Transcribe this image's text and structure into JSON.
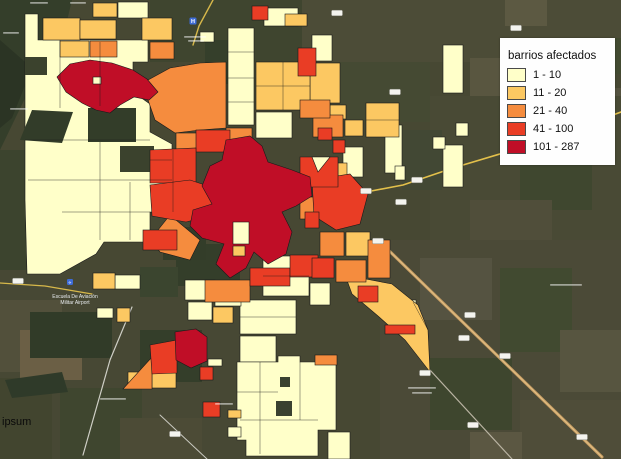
{
  "legend": {
    "title": "barrios afectados",
    "items": [
      {
        "label": "1 - 10",
        "color": "#FFFFC9"
      },
      {
        "label": "11 - 20",
        "color": "#FCC862"
      },
      {
        "label": "21 - 40",
        "color": "#F58C3E"
      },
      {
        "label": "41 - 100",
        "color": "#E93D25"
      },
      {
        "label": "101 - 287",
        "color": "#C00E27"
      }
    ]
  },
  "watermark": "ipsum",
  "markers": {
    "hospital": {
      "x": 193,
      "y": 21,
      "color": "#3d6bd6",
      "glyph": "H"
    },
    "airport": {
      "x": 70,
      "y": 282,
      "color": "#3d6bd6",
      "glyph": "✈",
      "label_line1": "Escuela De Aviación",
      "label_line2": "Militar Airport"
    }
  },
  "map": {
    "background": "#474833",
    "stroke": "#1a1a1a",
    "sat_patches": [
      {
        "x": 0,
        "y": 0,
        "w": 621,
        "h": 459,
        "f": "#474833"
      },
      {
        "pts": "0,0 72,0 58,58 28,92 0,150",
        "f": "#343e2a"
      },
      {
        "pts": "0,40 32,68 12,118 0,128",
        "f": "#2b3424"
      },
      {
        "x": 300,
        "y": 0,
        "w": 321,
        "h": 62,
        "f": "#4c4c37"
      },
      {
        "x": 505,
        "y": 0,
        "w": 42,
        "h": 26,
        "f": "#5c5942"
      },
      {
        "x": 560,
        "y": 38,
        "w": 61,
        "h": 36,
        "f": "#424a31"
      },
      {
        "x": 470,
        "y": 58,
        "w": 36,
        "h": 42,
        "f": "#595640"
      },
      {
        "x": 600,
        "y": 88,
        "w": 21,
        "h": 64,
        "f": "#555340"
      },
      {
        "x": 430,
        "y": 96,
        "w": 191,
        "h": 146,
        "f": "#494a35"
      },
      {
        "x": 520,
        "y": 148,
        "w": 72,
        "h": 62,
        "f": "#3f472f"
      },
      {
        "x": 470,
        "y": 200,
        "w": 82,
        "h": 56,
        "f": "#504e3a"
      },
      {
        "x": 380,
        "y": 240,
        "w": 241,
        "h": 219,
        "f": "#4b4a37"
      },
      {
        "x": 420,
        "y": 258,
        "w": 72,
        "h": 62,
        "f": "#555341"
      },
      {
        "x": 500,
        "y": 268,
        "w": 72,
        "h": 84,
        "f": "#414a30"
      },
      {
        "x": 560,
        "y": 330,
        "w": 61,
        "h": 62,
        "f": "#575540"
      },
      {
        "x": 430,
        "y": 358,
        "w": 82,
        "h": 72,
        "f": "#3e462e"
      },
      {
        "x": 520,
        "y": 400,
        "w": 101,
        "h": 59,
        "f": "#4f4d39"
      },
      {
        "x": 470,
        "y": 432,
        "w": 52,
        "h": 27,
        "f": "#5b5742"
      },
      {
        "x": 0,
        "y": 150,
        "w": 80,
        "h": 130,
        "f": "#3c442e"
      },
      {
        "x": 0,
        "y": 270,
        "w": 240,
        "h": 189,
        "f": "#474834"
      },
      {
        "x": 0,
        "y": 300,
        "w": 62,
        "h": 72,
        "f": "#52503b"
      },
      {
        "x": 20,
        "y": 330,
        "w": 62,
        "h": 50,
        "f": "#6b5f45"
      },
      {
        "x": 60,
        "y": 388,
        "w": 82,
        "h": 71,
        "f": "#3f462f"
      },
      {
        "x": 120,
        "y": 418,
        "w": 82,
        "h": 41,
        "f": "#4c4b36"
      },
      {
        "x": 0,
        "y": 378,
        "w": 52,
        "h": 81,
        "f": "#42452f"
      },
      {
        "x": 140,
        "y": 330,
        "w": 62,
        "h": 52,
        "f": "#343e2a"
      },
      {
        "x": 30,
        "y": 312,
        "w": 82,
        "h": 46,
        "f": "#313b28"
      },
      {
        "pts": "5,380 62,372 68,392 12,398",
        "f": "#2f3a29"
      },
      {
        "x": 150,
        "y": 0,
        "w": 152,
        "h": 62,
        "f": "#3f452f"
      },
      {
        "x": 205,
        "y": 40,
        "w": 42,
        "h": 44,
        "f": "#353f2b"
      },
      {
        "x": 176,
        "y": 244,
        "w": 64,
        "h": 42,
        "f": "#343e2a"
      },
      {
        "x": 340,
        "y": 62,
        "w": 90,
        "h": 60,
        "f": "#454a33"
      },
      {
        "x": 402,
        "y": 130,
        "w": 40,
        "h": 60,
        "f": "#424834"
      }
    ],
    "roads": [
      {
        "pts": "378,240 602,457",
        "f": "#c79e63",
        "w": 3
      },
      {
        "pts": "378,240 602,457",
        "f": "#e2bf86",
        "w": 1
      },
      {
        "pts": "430,370 512,459",
        "f": "#b9b3a2",
        "w": 1.2
      },
      {
        "pts": "132,307 110,360 83,455",
        "f": "#cfcfc6",
        "w": 1.2
      },
      {
        "pts": "160,415 207,459",
        "f": "#c9c9c0",
        "w": 1
      },
      {
        "pts": "621,112 540,142 453,168 403,185 366,192 320,200",
        "f": "#e3c04b",
        "w": 1.6
      },
      {
        "pts": "213,0 199,26 193,45",
        "f": "#d7b84a",
        "w": 1.4
      },
      {
        "pts": "0,283 45,286 92,294",
        "f": "#d7b84a",
        "w": 1.2
      }
    ],
    "parcels": [
      {
        "pts": "25,14 38,14 38,40 148,40 148,62 133,62 133,92 150,104 150,132 172,144 172,212 150,212 150,242 104,242 96,254 60,274 27,274 25,200",
        "c": 0
      },
      {
        "x": 88,
        "y": 108,
        "w": 48,
        "h": 34,
        "f": "#333d29"
      },
      {
        "pts": "32,110 73,112 62,143 20,140",
        "f": "#323c29"
      },
      {
        "x": 120,
        "y": 146,
        "w": 34,
        "h": 26,
        "f": "#3b422d"
      },
      {
        "x": 25,
        "y": 57,
        "w": 22,
        "h": 18,
        "f": "#3b422d"
      },
      {
        "x": 163,
        "y": 227,
        "w": 43,
        "h": 33,
        "f": "#333d29"
      },
      {
        "x": 140,
        "y": 267,
        "w": 38,
        "h": 30,
        "f": "#3b452f"
      },
      {
        "x": 228,
        "y": 28,
        "w": 26,
        "h": 97,
        "c": 0
      },
      {
        "x": 264,
        "y": 8,
        "w": 34,
        "h": 18,
        "c": 0
      },
      {
        "x": 118,
        "y": 2,
        "w": 30,
        "h": 16,
        "c": 0
      },
      {
        "x": 312,
        "y": 35,
        "w": 20,
        "h": 26,
        "c": 0
      },
      {
        "x": 256,
        "y": 112,
        "w": 36,
        "h": 26,
        "c": 0
      },
      {
        "x": 443,
        "y": 45,
        "w": 20,
        "h": 48,
        "c": 0
      },
      {
        "x": 443,
        "y": 145,
        "w": 20,
        "h": 42,
        "c": 0
      },
      {
        "x": 433,
        "y": 137,
        "w": 12,
        "h": 12,
        "c": 0
      },
      {
        "x": 456,
        "y": 123,
        "w": 12,
        "h": 13,
        "c": 0
      },
      {
        "x": 385,
        "y": 125,
        "w": 17,
        "h": 48,
        "c": 0
      },
      {
        "x": 395,
        "y": 166,
        "w": 10,
        "h": 14,
        "c": 0
      },
      {
        "x": 343,
        "y": 147,
        "w": 20,
        "h": 30,
        "c": 0
      },
      {
        "x": 263,
        "y": 256,
        "w": 46,
        "h": 40,
        "c": 0
      },
      {
        "x": 240,
        "y": 300,
        "w": 56,
        "h": 34,
        "c": 0
      },
      {
        "x": 185,
        "y": 280,
        "w": 30,
        "h": 20,
        "c": 0
      },
      {
        "x": 215,
        "y": 286,
        "w": 26,
        "h": 20,
        "c": 0
      },
      {
        "x": 188,
        "y": 302,
        "w": 24,
        "h": 18,
        "c": 0
      },
      {
        "x": 240,
        "y": 336,
        "w": 36,
        "h": 26,
        "c": 0
      },
      {
        "pts": "237,362 278,362 278,356 300,356 300,362 336,362 336,430 318,430 318,456 246,456 246,440 237,440",
        "c": 0
      },
      {
        "x": 280,
        "y": 377,
        "w": 10,
        "h": 10,
        "f": "#3a4130"
      },
      {
        "x": 276,
        "y": 401,
        "w": 16,
        "h": 15,
        "f": "#3a4130"
      },
      {
        "x": 328,
        "y": 432,
        "w": 22,
        "h": 27,
        "c": 0
      },
      {
        "x": 310,
        "y": 283,
        "w": 20,
        "h": 22,
        "c": 0
      },
      {
        "x": 115,
        "y": 275,
        "w": 25,
        "h": 14,
        "c": 0
      },
      {
        "x": 97,
        "y": 308,
        "w": 16,
        "h": 10,
        "c": 0
      },
      {
        "x": 208,
        "y": 359,
        "w": 14,
        "h": 7,
        "c": 0
      },
      {
        "x": 228,
        "y": 427,
        "w": 13,
        "h": 10,
        "c": 0
      },
      {
        "x": 200,
        "y": 32,
        "w": 14,
        "h": 10,
        "c": 0
      },
      {
        "x": 396,
        "y": 300,
        "w": 20,
        "h": 14,
        "c": 0
      },
      {
        "x": 43,
        "y": 18,
        "w": 37,
        "h": 22,
        "c": 1
      },
      {
        "x": 80,
        "y": 20,
        "w": 36,
        "h": 19,
        "c": 1
      },
      {
        "x": 60,
        "y": 41,
        "w": 29,
        "h": 16,
        "c": 1
      },
      {
        "x": 93,
        "y": 3,
        "w": 24,
        "h": 14,
        "c": 1
      },
      {
        "x": 142,
        "y": 18,
        "w": 30,
        "h": 22,
        "c": 1
      },
      {
        "x": 285,
        "y": 14,
        "w": 22,
        "h": 12,
        "c": 1
      },
      {
        "x": 310,
        "y": 63,
        "w": 30,
        "h": 40,
        "c": 1
      },
      {
        "x": 256,
        "y": 62,
        "w": 54,
        "h": 48,
        "c": 1
      },
      {
        "x": 366,
        "y": 103,
        "w": 33,
        "h": 34,
        "c": 1
      },
      {
        "x": 330,
        "y": 105,
        "w": 16,
        "h": 14,
        "c": 1
      },
      {
        "x": 345,
        "y": 120,
        "w": 18,
        "h": 16,
        "c": 1
      },
      {
        "x": 338,
        "y": 163,
        "w": 9,
        "h": 30,
        "c": 1
      },
      {
        "pts": "345,275 392,284 418,305 428,330 430,372 405,340 378,316 352,294",
        "c": 1
      },
      {
        "x": 346,
        "y": 232,
        "w": 24,
        "h": 24,
        "c": 1
      },
      {
        "x": 213,
        "y": 307,
        "w": 20,
        "h": 16,
        "c": 1
      },
      {
        "x": 93,
        "y": 273,
        "w": 22,
        "h": 16,
        "c": 1
      },
      {
        "x": 117,
        "y": 308,
        "w": 13,
        "h": 14,
        "c": 1
      },
      {
        "x": 152,
        "y": 372,
        "w": 24,
        "h": 16,
        "c": 1
      },
      {
        "x": 128,
        "y": 372,
        "w": 12,
        "h": 12,
        "c": 1
      },
      {
        "x": 228,
        "y": 410,
        "w": 13,
        "h": 8,
        "c": 1
      },
      {
        "pts": "148,80 170,68 200,63 226,62 226,128 200,130 175,133 155,120 148,100",
        "c": 2
      },
      {
        "x": 176,
        "y": 133,
        "w": 50,
        "h": 18,
        "c": 2
      },
      {
        "x": 90,
        "y": 41,
        "w": 27,
        "h": 16,
        "c": 2
      },
      {
        "x": 150,
        "y": 42,
        "w": 24,
        "h": 17,
        "c": 2
      },
      {
        "x": 226,
        "y": 128,
        "w": 26,
        "h": 14,
        "c": 2
      },
      {
        "x": 313,
        "y": 115,
        "w": 30,
        "h": 22,
        "c": 2
      },
      {
        "x": 300,
        "y": 100,
        "w": 30,
        "h": 18,
        "c": 2
      },
      {
        "pts": "170,215 200,240 190,260 160,252 150,240",
        "c": 2
      },
      {
        "x": 205,
        "y": 280,
        "w": 45,
        "h": 22,
        "c": 2
      },
      {
        "x": 320,
        "y": 232,
        "w": 24,
        "h": 24,
        "c": 2
      },
      {
        "x": 336,
        "y": 260,
        "w": 30,
        "h": 22,
        "c": 2
      },
      {
        "x": 368,
        "y": 240,
        "w": 22,
        "h": 38,
        "c": 2
      },
      {
        "x": 300,
        "y": 197,
        "w": 53,
        "h": 22,
        "c": 2
      },
      {
        "pts": "123,389 152,357 152,389",
        "c": 2
      },
      {
        "x": 315,
        "y": 355,
        "w": 22,
        "h": 10,
        "c": 2
      },
      {
        "x": 252,
        "y": 6,
        "w": 16,
        "h": 14,
        "c": 3
      },
      {
        "x": 298,
        "y": 48,
        "w": 18,
        "h": 28,
        "c": 3
      },
      {
        "x": 196,
        "y": 130,
        "w": 34,
        "h": 22,
        "c": 3
      },
      {
        "pts": "150,150 196,148 196,183 150,183",
        "c": 3
      },
      {
        "pts": "150,185 190,180 214,188 210,216 186,222 152,216",
        "c": 3
      },
      {
        "pts": "312,180 350,174 368,194 360,224 336,230 314,216",
        "c": 3
      },
      {
        "x": 143,
        "y": 230,
        "w": 34,
        "h": 20,
        "c": 3
      },
      {
        "x": 250,
        "y": 268,
        "w": 40,
        "h": 18,
        "c": 3
      },
      {
        "x": 290,
        "y": 255,
        "w": 28,
        "h": 22,
        "c": 3
      },
      {
        "x": 333,
        "y": 140,
        "w": 12,
        "h": 13,
        "c": 3
      },
      {
        "x": 318,
        "y": 128,
        "w": 14,
        "h": 12,
        "c": 3
      },
      {
        "pts": "300,157 338,157 338,187 300,187",
        "c": 3
      },
      {
        "x": 312,
        "y": 258,
        "w": 22,
        "h": 20,
        "c": 3
      },
      {
        "x": 358,
        "y": 286,
        "w": 20,
        "h": 16,
        "c": 3
      },
      {
        "x": 385,
        "y": 325,
        "w": 30,
        "h": 9,
        "c": 3
      },
      {
        "pts": "150,345 177,340 177,373 152,374",
        "c": 3
      },
      {
        "x": 200,
        "y": 367,
        "w": 13,
        "h": 13,
        "c": 3
      },
      {
        "x": 203,
        "y": 402,
        "w": 17,
        "h": 15,
        "c": 3
      },
      {
        "x": 305,
        "y": 212,
        "w": 14,
        "h": 16,
        "c": 3
      },
      {
        "pts": "57,77 70,64 90,60 112,63 133,70 147,79 158,92 149,100 134,97 120,105 110,113 96,110 82,103 66,92",
        "c": 4
      },
      {
        "pts": "226,140 250,136 262,146 268,162 292,170 310,177 312,196 296,206 282,212 292,232 286,254 268,264 254,252 246,268 230,278 216,264 224,244 202,238 190,226 193,210 212,204 202,186 210,166 222,160",
        "c": 4
      },
      {
        "pts": "175,332 196,329 207,337 207,361 191,368 176,360",
        "c": 4
      },
      {
        "x": 93,
        "y": 77,
        "w": 8,
        "h": 7,
        "c": 0
      },
      {
        "x": 233,
        "y": 222,
        "w": 16,
        "h": 22,
        "c": 0
      },
      {
        "x": 233,
        "y": 246,
        "w": 12,
        "h": 10,
        "c": 1
      },
      {
        "pts": "312,157 330,157 318,172",
        "c": 0
      }
    ],
    "lines": [
      {
        "pts": "60,40 60,108"
      },
      {
        "pts": "100,42 100,106"
      },
      {
        "pts": "25,140 150,140"
      },
      {
        "pts": "28,180 172,180"
      },
      {
        "pts": "62,212 150,212"
      },
      {
        "pts": "100,142 100,240"
      },
      {
        "pts": "130,182 130,240"
      },
      {
        "pts": "228,52 254,52"
      },
      {
        "pts": "228,78 254,78"
      },
      {
        "pts": "228,102 254,102"
      },
      {
        "pts": "256,86 310,86"
      },
      {
        "pts": "283,62 283,110"
      },
      {
        "pts": "260,362 260,454"
      },
      {
        "pts": "237,392 278,392"
      },
      {
        "pts": "300,362 300,420"
      },
      {
        "pts": "240,420 318,420"
      },
      {
        "pts": "263,276 309,276"
      },
      {
        "pts": "240,317 296,317"
      },
      {
        "pts": "366,120 399,120"
      },
      {
        "pts": "173,150 173,212"
      },
      {
        "pts": "150,160 172,160"
      },
      {
        "pts": "413,302 428,330"
      }
    ],
    "shields": [
      [
        337,
        13
      ],
      [
        516,
        28
      ],
      [
        395,
        92
      ],
      [
        417,
        180
      ],
      [
        366,
        191
      ],
      [
        401,
        202
      ],
      [
        378,
        241
      ],
      [
        470,
        315
      ],
      [
        464,
        338
      ],
      [
        505,
        356
      ],
      [
        473,
        425
      ],
      [
        582,
        437
      ],
      [
        175,
        434
      ],
      [
        18,
        281
      ],
      [
        425,
        373
      ]
    ],
    "smudges": [
      [
        184,
        36,
        22
      ],
      [
        188,
        40,
        16
      ],
      [
        100,
        398,
        26
      ],
      [
        215,
        403,
        18
      ],
      [
        408,
        387,
        28
      ],
      [
        412,
        392,
        20
      ],
      [
        550,
        284,
        32
      ],
      [
        30,
        2,
        18
      ],
      [
        70,
        2,
        16
      ],
      [
        3,
        32,
        16
      ],
      [
        10,
        108,
        18
      ]
    ]
  }
}
